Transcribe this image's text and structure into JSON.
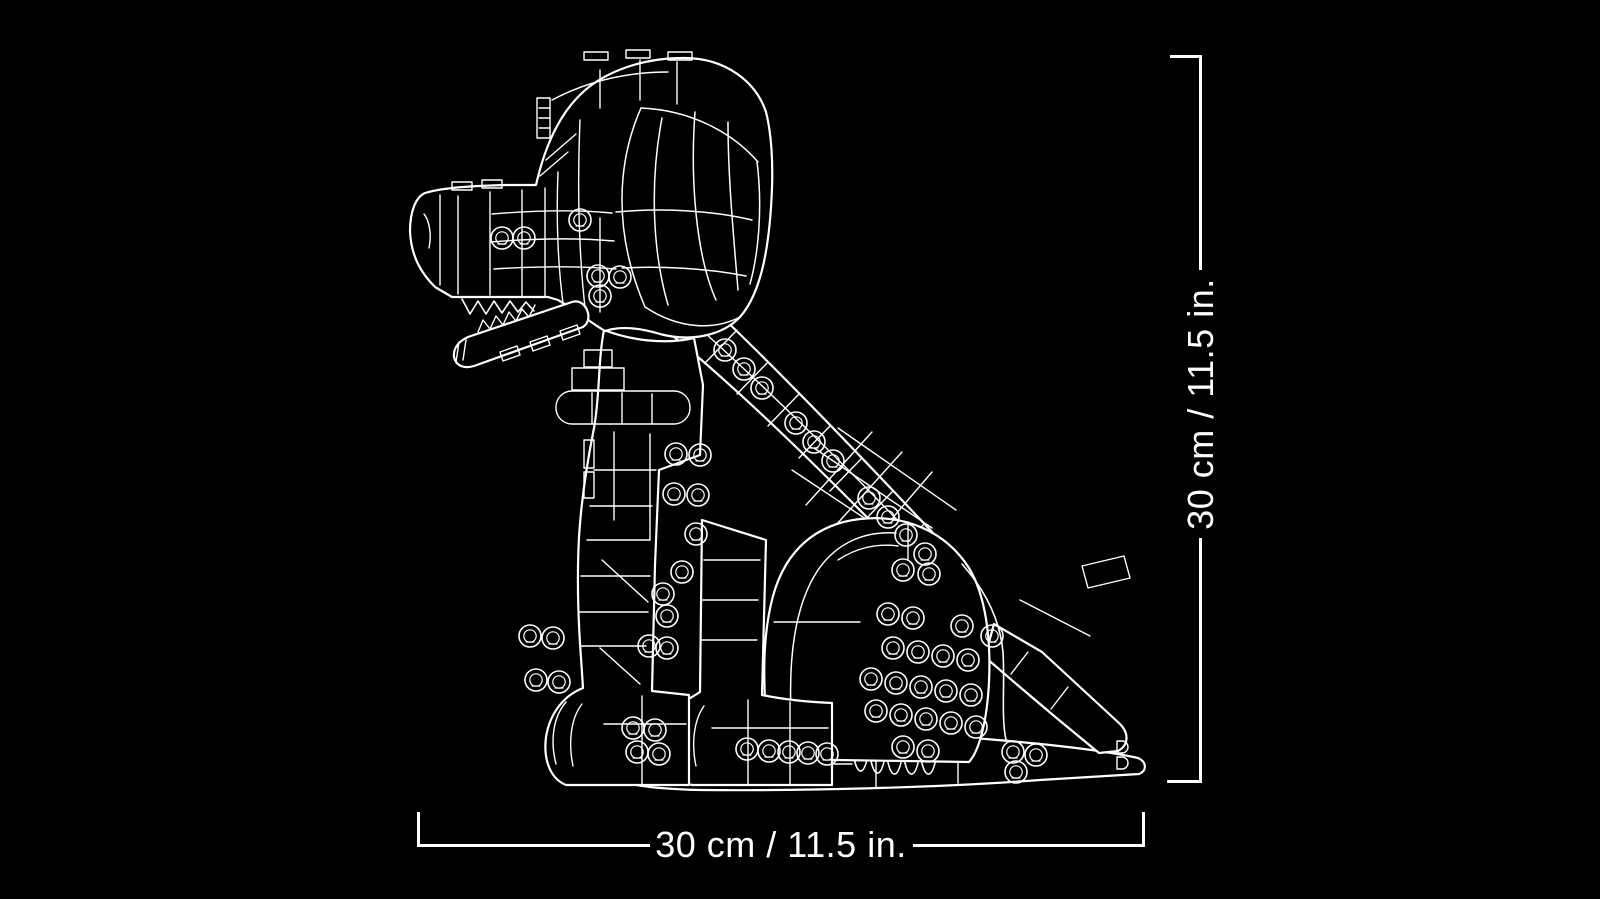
{
  "canvas": {
    "background_color": "#000000",
    "line_color": "#ffffff"
  },
  "illustration": {
    "name": "brick-built-dog-side-view-line-art",
    "description": "White wireframe line art of a sitting brick-built dog, side view, with stud circles"
  },
  "annotations": {
    "height": {
      "label": "30 cm / 11.5 in."
    },
    "width": {
      "label": "30 cm / 11.5 in."
    }
  }
}
